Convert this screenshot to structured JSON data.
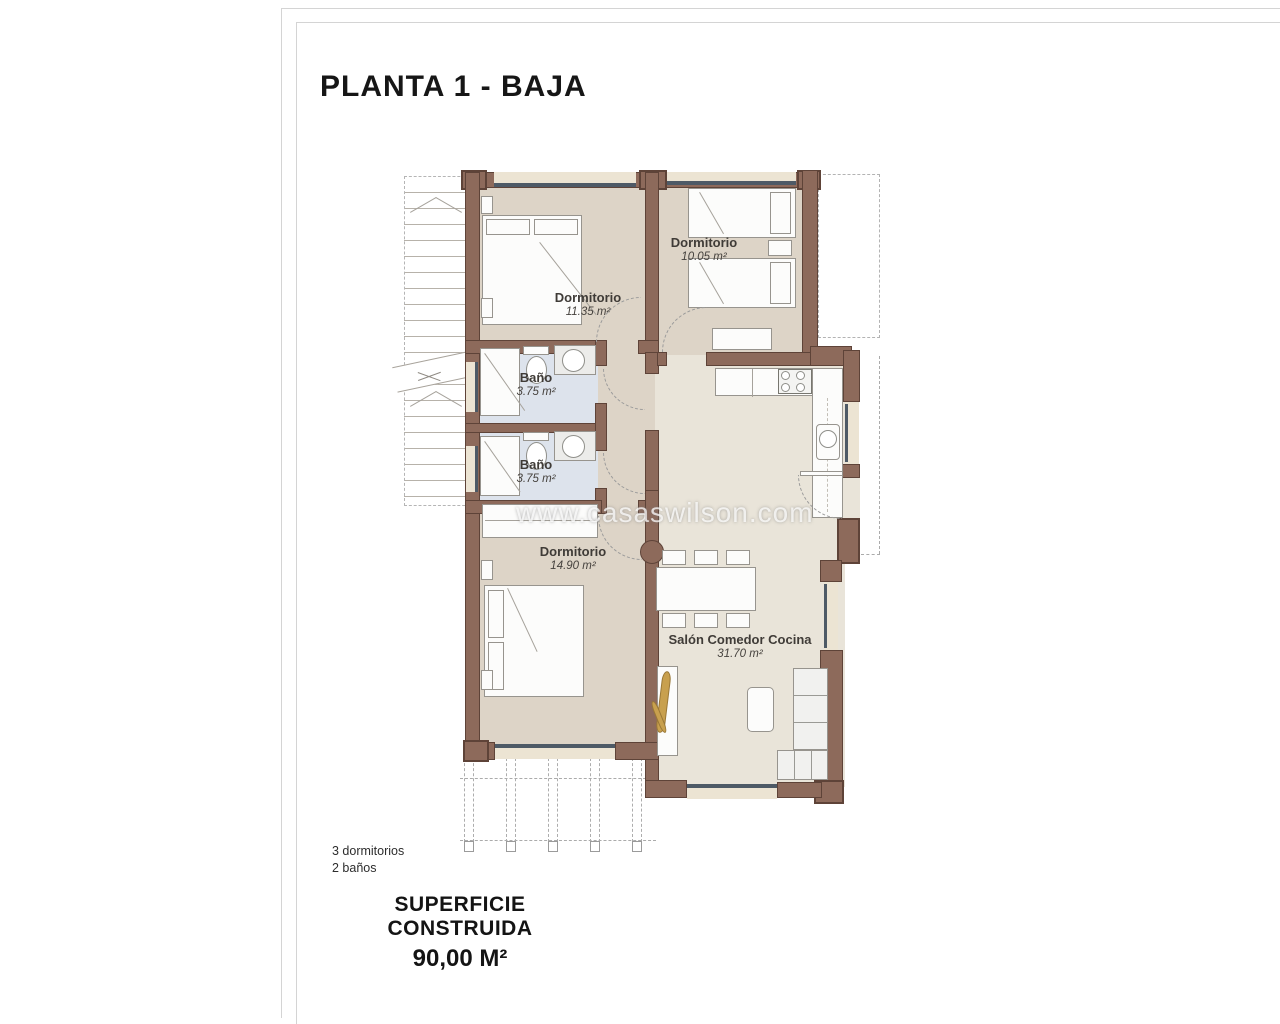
{
  "title": "PLANTA 1 - BAJA",
  "watermark": "www.casaswilson.com",
  "rooms": [
    {
      "name": "Dormitorio",
      "area": "11.35 m²"
    },
    {
      "name": "Dormitorio",
      "area": "10.05 m²"
    },
    {
      "name": "Baño",
      "area": "3.75 m²"
    },
    {
      "name": "Baño",
      "area": "3.75 m²"
    },
    {
      "name": "Dormitorio",
      "area": "14.90 m²"
    },
    {
      "name": "Salón Comedor Cocina",
      "area": "31.70 m²"
    }
  ],
  "summary": {
    "bedrooms": "3 dormitorios",
    "bathrooms": "2 baños",
    "surface_label": "SUPERFICIE CONSTRUIDA",
    "surface_value": "90,00 M²"
  },
  "colors": {
    "wall": "#8d6a5b",
    "wall_outline": "#5e4338",
    "bedroom_floor": "#ddd4c7",
    "bath_floor": "#dde3ec",
    "salon_floor": "#e9e4d9",
    "window": "#4e5a66",
    "wood_accent": "#c8a04e"
  }
}
